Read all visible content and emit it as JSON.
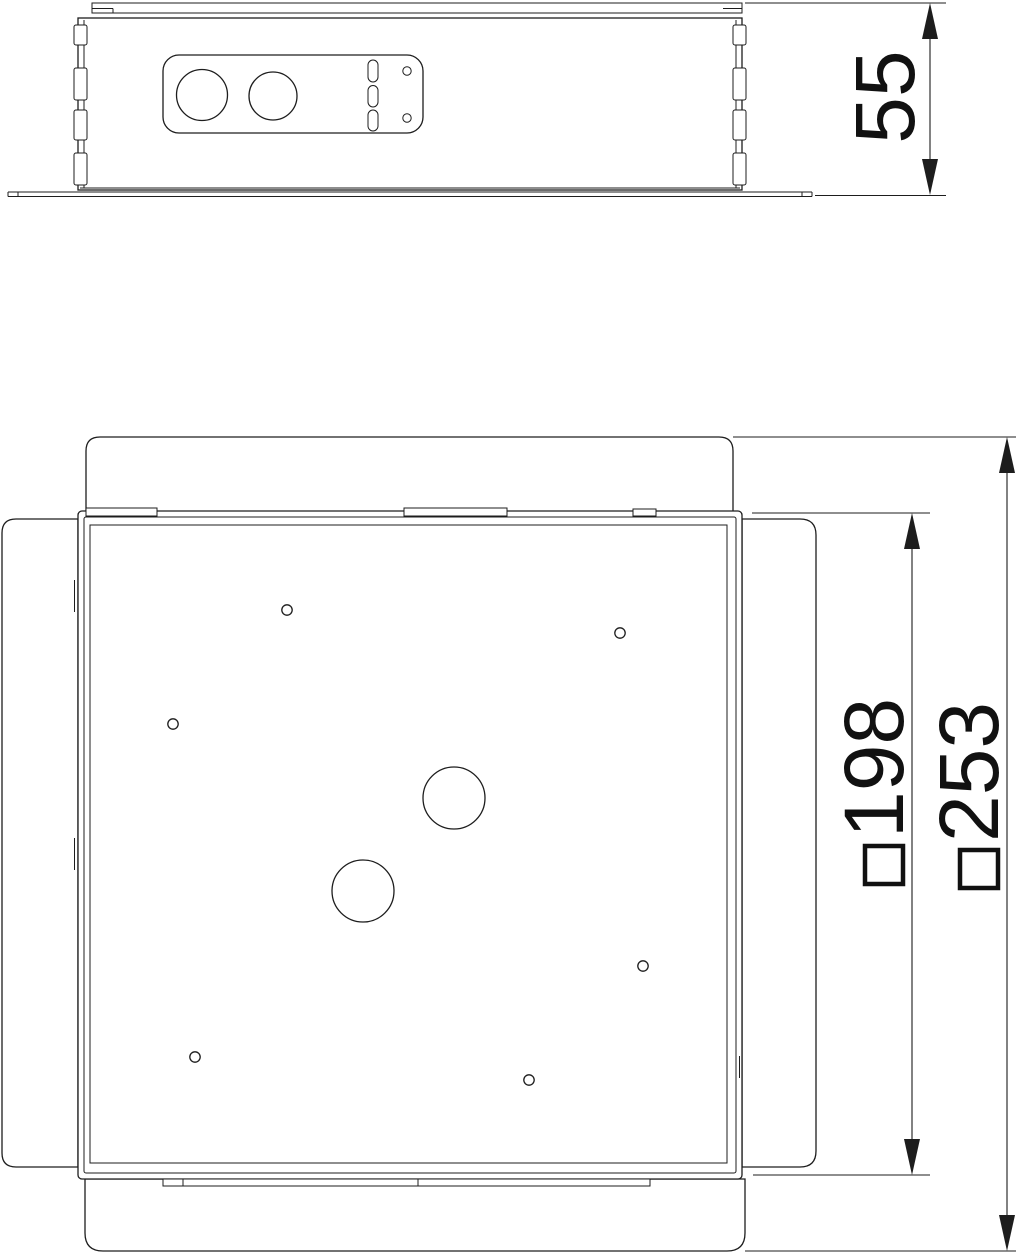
{
  "document": {
    "type_label": "technical-dimension-drawing",
    "background": "#ffffff",
    "line_color": "#1d1d1d"
  },
  "side_view": {
    "height_dimension": {
      "value": "55"
    }
  },
  "plan_view": {
    "inner_square_dimension": {
      "symbol": "□",
      "value": "198"
    },
    "outer_square_dimension": {
      "symbol": "□",
      "value": "253"
    }
  }
}
